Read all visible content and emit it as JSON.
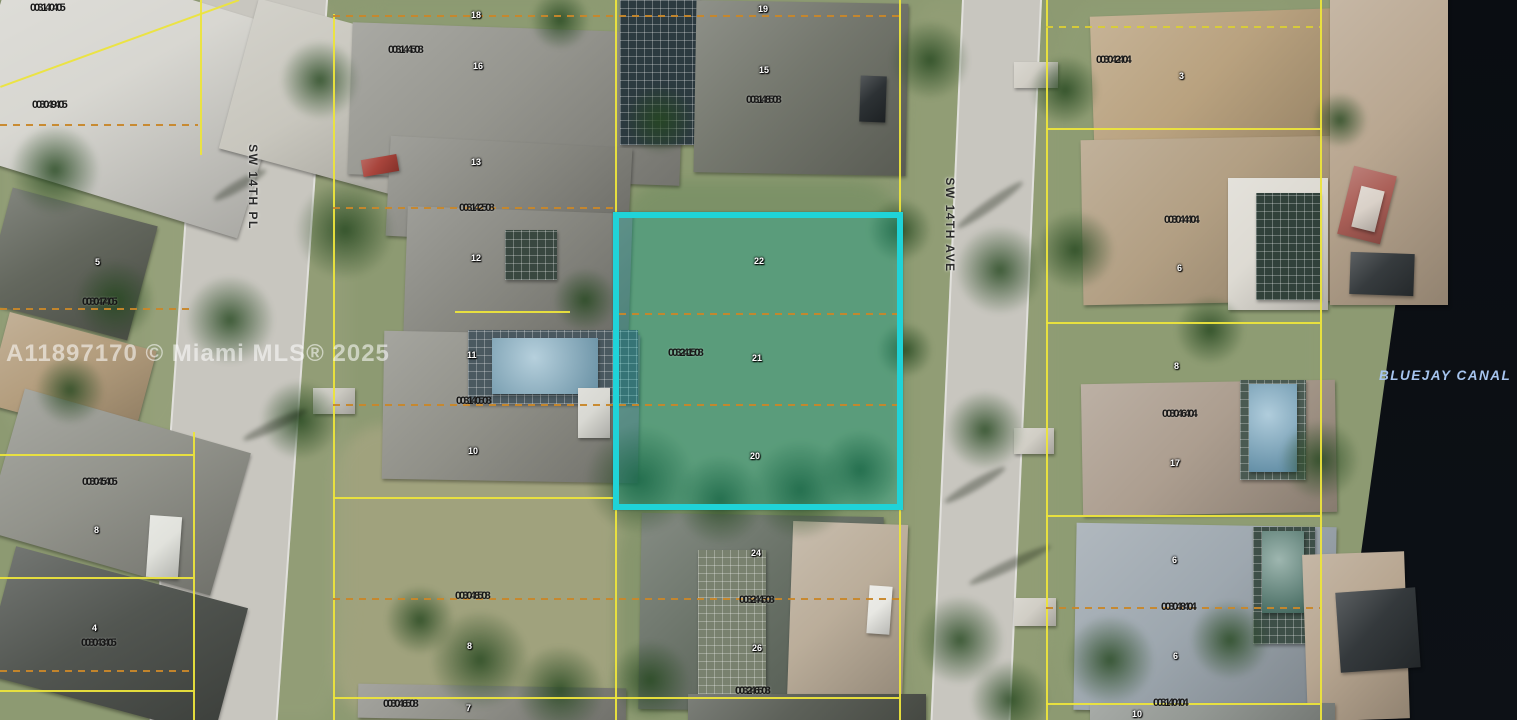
{
  "map": {
    "watermark": "A11897170 © Miami MLS® 2025",
    "streets": [
      {
        "name": "SW 14TH PL"
      },
      {
        "name": "SW 14TH AVE"
      }
    ],
    "canal": {
      "label": "BLUEJAY CANAL"
    },
    "highlight": {
      "parcel_id": "03458 0210"
    },
    "colors": {
      "highlight": "#1fd3d8",
      "parcel_line": "#ece43c",
      "lot_line_dashed": "#c8872a",
      "water": "#0b0e13",
      "canal_text": "#a6c4ee",
      "label_text": "#151515"
    },
    "parcel_labels": [
      {
        "line1": "03445",
        "line2": "0100",
        "x": 30,
        "y": 3
      },
      {
        "line1": "03445",
        "line2": "0090",
        "x": 32,
        "y": 100
      },
      {
        "line1": "03458",
        "line2": "0140",
        "x": 388,
        "y": 45
      },
      {
        "line1": "03458",
        "line2": "0180",
        "x": 746,
        "y": 95
      },
      {
        "line1": "03444",
        "line2": "0020",
        "x": 1096,
        "y": 55
      },
      {
        "line1": "03458",
        "line2": "0120",
        "x": 459,
        "y": 203
      },
      {
        "line1": "03444",
        "line2": "0040",
        "x": 1164,
        "y": 215
      },
      {
        "line1": "03445",
        "line2": "0070",
        "x": 82,
        "y": 297
      },
      {
        "line1": "03458",
        "line2": "0210",
        "x": 668,
        "y": 348
      },
      {
        "line1": "03458",
        "line2": "0100",
        "x": 456,
        "y": 396
      },
      {
        "line1": "03444",
        "line2": "0060",
        "x": 1162,
        "y": 409
      },
      {
        "line1": "03445",
        "line2": "0050",
        "x": 82,
        "y": 477
      },
      {
        "line1": "03458",
        "line2": "0080",
        "x": 455,
        "y": 591
      },
      {
        "line1": "03458",
        "line2": "0240",
        "x": 739,
        "y": 595
      },
      {
        "line1": "03444",
        "line2": "0080",
        "x": 1161,
        "y": 602
      },
      {
        "line1": "03445",
        "line2": "0030",
        "x": 81,
        "y": 638
      },
      {
        "line1": "03458",
        "line2": "0260",
        "x": 735,
        "y": 686
      },
      {
        "line1": "03458",
        "line2": "0060",
        "x": 383,
        "y": 699
      },
      {
        "line1": "03444",
        "line2": "0100",
        "x": 1153,
        "y": 698
      }
    ],
    "house_numbers": [
      {
        "n": "18",
        "x": 471,
        "y": 11
      },
      {
        "n": "16",
        "x": 473,
        "y": 62
      },
      {
        "n": "19",
        "x": 758,
        "y": 5
      },
      {
        "n": "15",
        "x": 759,
        "y": 66
      },
      {
        "n": "3",
        "x": 1179,
        "y": 72
      },
      {
        "n": "13",
        "x": 471,
        "y": 158
      },
      {
        "n": "12",
        "x": 471,
        "y": 254
      },
      {
        "n": "6",
        "x": 1177,
        "y": 264
      },
      {
        "n": "8",
        "x": 1174,
        "y": 362
      },
      {
        "n": "11",
        "x": 467,
        "y": 351
      },
      {
        "n": "10",
        "x": 468,
        "y": 447
      },
      {
        "n": "22",
        "x": 754,
        "y": 257
      },
      {
        "n": "21",
        "x": 752,
        "y": 354
      },
      {
        "n": "20",
        "x": 750,
        "y": 452
      },
      {
        "n": "5",
        "x": 95,
        "y": 258
      },
      {
        "n": "8",
        "x": 94,
        "y": 526
      },
      {
        "n": "4",
        "x": 92,
        "y": 624
      },
      {
        "n": "24",
        "x": 751,
        "y": 549
      },
      {
        "n": "26",
        "x": 752,
        "y": 644
      },
      {
        "n": "17",
        "x": 1170,
        "y": 459
      },
      {
        "n": "6",
        "x": 1172,
        "y": 556
      },
      {
        "n": "6",
        "x": 1173,
        "y": 652
      },
      {
        "n": "8",
        "x": 467,
        "y": 642
      },
      {
        "n": "7",
        "x": 466,
        "y": 704
      },
      {
        "n": "10",
        "x": 1132,
        "y": 710
      }
    ]
  }
}
